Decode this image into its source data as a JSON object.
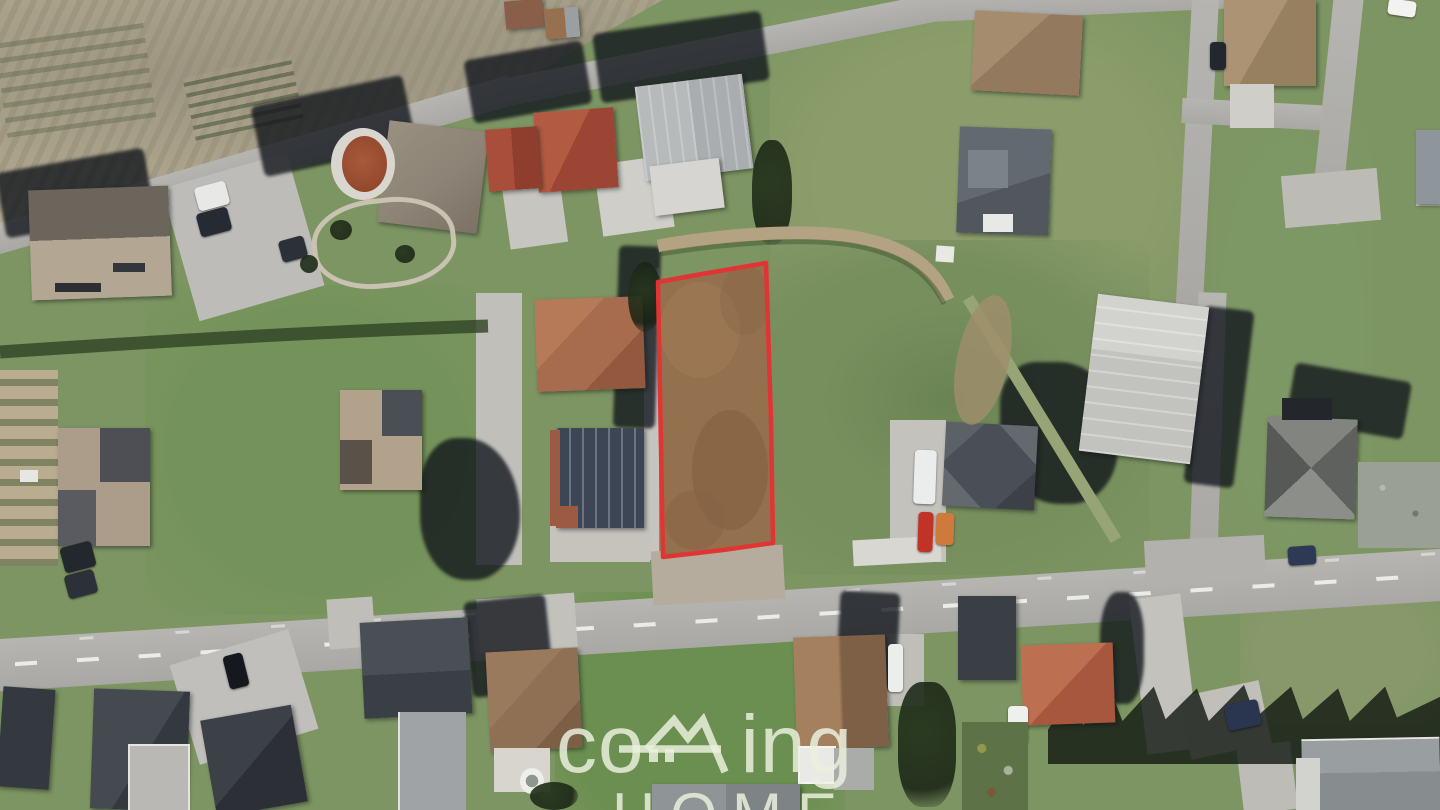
{
  "scene": {
    "type": "aerial-photograph",
    "description": "Top-down aerial view of a residential neighborhood with a vacant building plot highlighted by a red outline",
    "highlighted_parcel": {
      "outline_color": "#e13434",
      "ground_color": "#93704e",
      "description": "brown dirt plot outlined in red"
    }
  },
  "watermark": {
    "prefix": "co",
    "suffix": "ing",
    "line2": "HOME",
    "color": "#eaf0dd",
    "logo_glyph": "house-roof-key-m"
  },
  "palette": {
    "grass": "#7d9562",
    "road": "#b2b1ad",
    "hillside": "#b4ab92",
    "shadow": "#10141b"
  }
}
